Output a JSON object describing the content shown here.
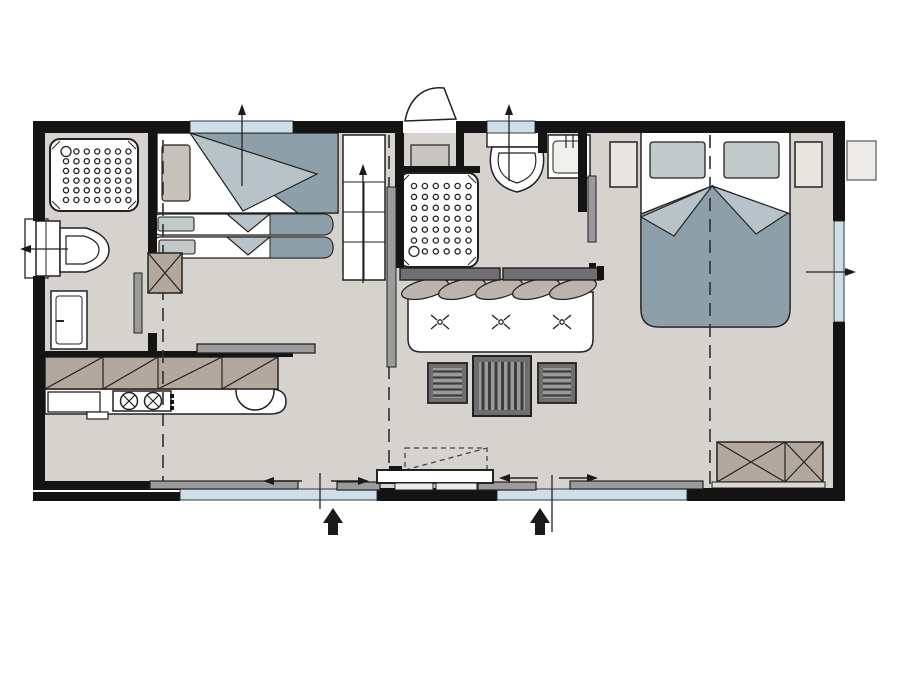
{
  "title": "Mobile home floor plan (top-down architectural drawing, no text labels)",
  "colors": {
    "background": "#ffffff",
    "wall": "#141414",
    "floor": "#d6d2cd",
    "window_glazing": "#cfdfe9",
    "line": "#222222",
    "blanket_dark": "#8da0a9",
    "blanket_light": "#b7c3c9",
    "pillow_gray": "#c3c8c9",
    "pillow_beige": "#c6c2bb",
    "cabinet_brown": "#b2a89e",
    "slider_gray": "#9b9b9b",
    "bar_dark": "#6f6f6f",
    "stripe_dark": "#3d3d3d",
    "stripe_mid": "#9a9a9a",
    "cushion_gray": "#b9b5ae",
    "nightstand": "#e9e6e2",
    "front_strip": "#dcd9d5",
    "exterior_box": "#eceae7",
    "vestibule_cabinet": "#c8c4bf",
    "table_frame": "#6e6e6e"
  },
  "legend": {
    "rooms": [
      "bathroom-with-shower-and-wc",
      "kids-bedroom-with-pullout-beds",
      "entry-vestibule",
      "second-shower-room-with-wc-and-basin",
      "open-living-kitchen",
      "master-bedroom"
    ],
    "fixtures": [
      "shower-tray-1",
      "toilet-1",
      "vanity-cabinet",
      "shower-tray-2",
      "toilet-2",
      "washbasin",
      "fridge",
      "hob-2-burners",
      "round-kitchen-sink",
      "overhead-cabinets-hatched",
      "breakfast-bar"
    ],
    "furniture": [
      "single-bed-with-blanket",
      "pull-out-bed-upper",
      "pull-out-bed-lower",
      "wardrobe-column-x",
      "shelf-unit-with-arrow",
      "sofa-3-seat",
      "striped-coffee-table",
      "stool-left",
      "stool-right",
      "double-bed",
      "nightstand-left",
      "nightstand-right",
      "wardrobe-x",
      "exterior-utility-box"
    ],
    "openings": [
      "entrance-door-with-swing-arc",
      "window-top-left",
      "window-top-middle",
      "window-behind-toilet-left",
      "window-right",
      "sliding-glass-front-left",
      "sliding-glass-front-right",
      "main-sliding-entrance-door",
      "sliding-room-doors-gray-panels"
    ],
    "annotations": [
      "dashed-module-split-lines",
      "black-entrance-arrows",
      "window-opening-arrows",
      "slider-direction-arrows",
      "dashed-porch-step"
    ]
  },
  "shower_dots": {
    "shower1": {
      "x0": 66,
      "y0": 151.5,
      "cols": 7,
      "rows": 6,
      "dx": 10.4,
      "dy": 9.7,
      "big": {
        "col": 0,
        "row": 0,
        "r": 5
      }
    },
    "shower2": {
      "x0": 414,
      "y0": 186,
      "cols": 6,
      "rows": 7,
      "dx": 10.9,
      "dy": 10.9,
      "big": {
        "col": 0,
        "row": 6,
        "r": 5
      }
    }
  }
}
